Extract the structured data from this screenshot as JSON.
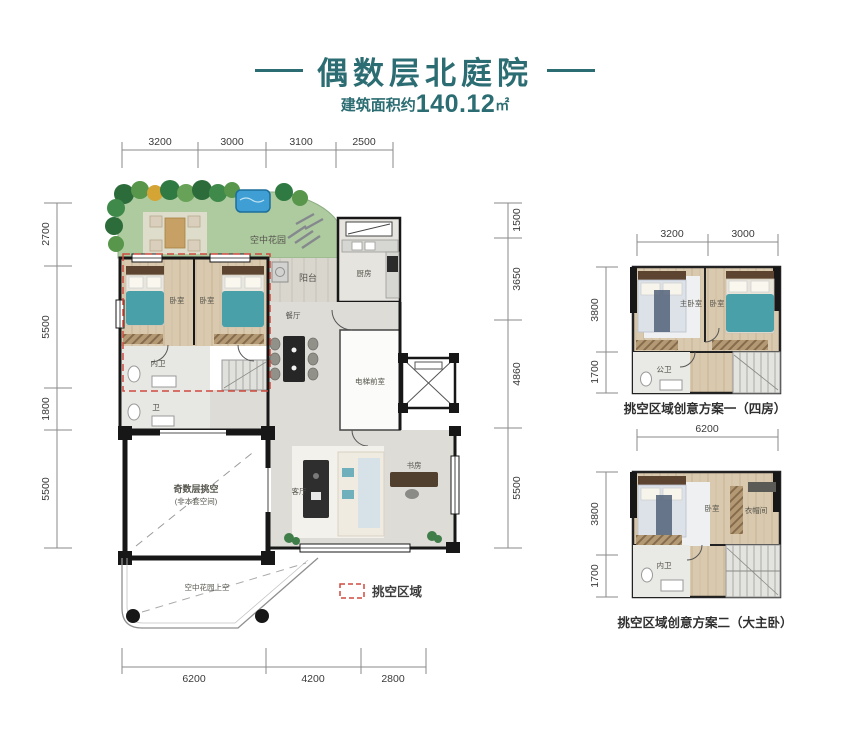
{
  "header": {
    "title": "偶数层北庭院",
    "subtitle_prefix": "建筑面积约",
    "area_value": "140.12",
    "area_unit": "㎡"
  },
  "colors": {
    "accent_teal": "#2b6d72",
    "void_dash_red": "#cf4a3f",
    "garden_green": "#aecba0",
    "pool_blue": "#3f9fd4",
    "bed_teal": "#4aa0a8",
    "wall_black": "#171717"
  },
  "legend": {
    "void_label": "挑空区域"
  },
  "main_plan": {
    "dims_top": [
      "3200",
      "3000",
      "3100",
      "2500"
    ],
    "dims_left": [
      "2700",
      "5500",
      "1800",
      "5500"
    ],
    "dims_right": [
      "1500",
      "3650",
      "4860",
      "5500"
    ],
    "dims_bottom": [
      "6200",
      "4200",
      "2800"
    ],
    "rooms": {
      "sky_garden": "空中花园",
      "balcony": "阳台",
      "kitchen": "厨房",
      "bedroom": "卧室",
      "dining": "餐厅",
      "inner_bath": "内卫",
      "bath": "卫",
      "elevator_lobby": "电梯前室",
      "void_line1": "奇数层挑空",
      "void_line2": "(非本套空间)",
      "living": "客厅",
      "study": "书房",
      "garden_above": "空中花园上空"
    }
  },
  "plan_one": {
    "caption": "挑空区域创意方案一（四房）",
    "dims_top": [
      "3200",
      "3000"
    ],
    "dims_left": [
      "3800",
      "1700"
    ],
    "rooms": {
      "master": "主卧室",
      "bedroom": "卧室",
      "public_bath": "公卫"
    }
  },
  "plan_two": {
    "caption": "挑空区域创意方案二（大主卧）",
    "dims_top": [
      "6200"
    ],
    "dims_left": [
      "3800",
      "1700"
    ],
    "rooms": {
      "bedroom": "卧室",
      "closet": "衣帽间",
      "inner_bath": "内卫"
    }
  }
}
